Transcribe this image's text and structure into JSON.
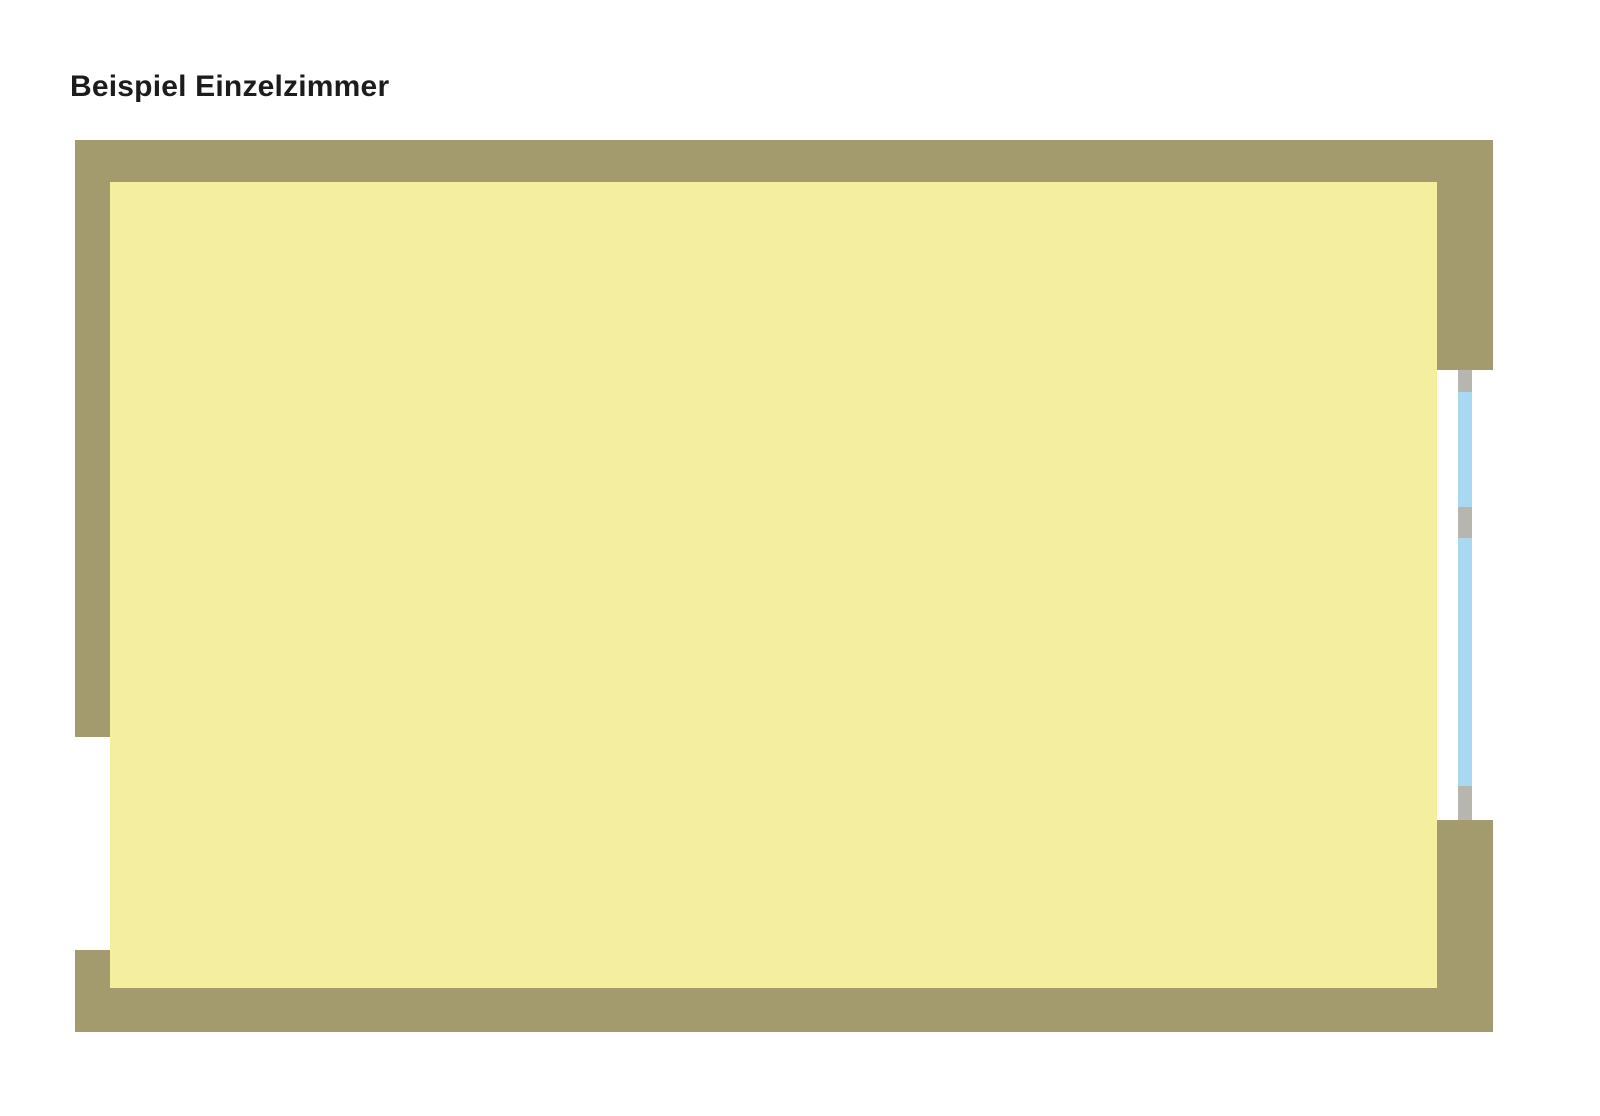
{
  "title": {
    "text": "Beispiel Einzelzimmer"
  },
  "colors": {
    "background": "#ffffff",
    "title_text": "#1c1c1c",
    "wall": "#a39a6e",
    "partition_wall": "#a29c82",
    "floor": "#f4ef9e",
    "tile": "#f7c890",
    "tile_grout": "#ffffff",
    "window_glass": "#a9d8f3",
    "window_frame": "#b6b6af",
    "bed_frame_gray": "#a9a9a4",
    "mattress": "#fbfaf2",
    "pillow_blue": "#b5cfe5",
    "pillow_outline": "#62625b",
    "blanket_blue": "#a9c6e2",
    "blanket_fold_blue": "#92b3d3",
    "lamp_yellow": "#e9e075",
    "table_dark_brown": "#2f1b0d",
    "chair_cream": "#f3efdb",
    "chair_outline": "#3c2512",
    "centerpiece_plate_tan": "#a8906f",
    "leaf_olive_green": "#74942f",
    "flower_white": "#ffffff",
    "sofa_brown": "#7b5c31",
    "sofa_backrest_dark": "#2f1b0b",
    "sofa_inset_cream": "#e7dfc0",
    "door_dark_brown": "#45220f",
    "wardrobe_dark_brown": "#3a1c0c",
    "plant_light_green": "#a2cf4a",
    "plant_mid_green": "#69a832",
    "plant_dark_green": "#14311c",
    "plant_stem_brown": "#7a4f28",
    "fixture_white": "#fdfdfa",
    "fixture_border_gray": "#b9b9b3"
  }
}
